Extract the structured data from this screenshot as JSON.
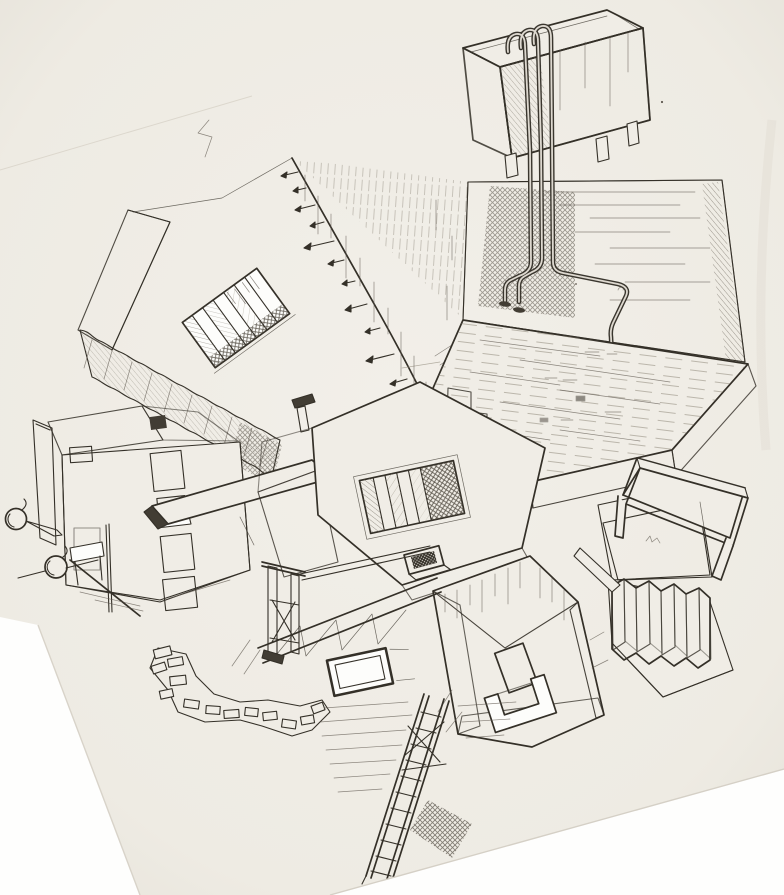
{
  "scene": {
    "description": "Hand-drawn pencil and ink architectural sketch on tilted scanned paper: an Escher-like impossible assembly of buildings, staircases, a pipe-topped tank on legs, plank platform, sunken stair pit, table over a pit, accordion-folded wall, truss girder, crumbling brick band and leaning ladders.",
    "elements": [
      {
        "name": "tank-box-with-pipes",
        "note": "hatched box on short legs, three pipes hooked over its rim"
      },
      {
        "name": "pipe-run",
        "note": "pipes descend a hatched concrete wall and plunge into a plank platform"
      },
      {
        "name": "plank-platform",
        "note": "large tilted wooden slab with plank dashes and notched corner"
      },
      {
        "name": "arrow-ridge-wall",
        "note": "large blank wall with a ridge studded with small left-pointing arrows"
      },
      {
        "name": "stair-window",
        "note": "rotated rectangular opening with steps inside"
      },
      {
        "name": "zigzag-stair-band",
        "note": "scalloped staircase edge descending left to right"
      },
      {
        "name": "left-house",
        "note": "small house with dark windows, hatched roof, porch and two sphere balloons on strings"
      },
      {
        "name": "center-stair-pit-platform",
        "note": "white platform with sunken staircase pit, peg and skylight hatch"
      },
      {
        "name": "table-over-pit",
        "note": "table structure standing above a dark cross-hatched pit"
      },
      {
        "name": "accordion-fold",
        "note": "zigzag folded wall standing on a slab"
      },
      {
        "name": "keyhole-building",
        "note": "rotated building with dark window and U-shaped balcony parapet"
      },
      {
        "name": "truss-girder",
        "note": "lattice girder and braced tower posts"
      },
      {
        "name": "framed-window",
        "note": "small dark framed window lying on a white plane"
      },
      {
        "name": "brick-crumble-band",
        "note": "ragged band of crumbling bricks"
      },
      {
        "name": "ladder",
        "note": "long braced ladder leaning across the lower sheet"
      },
      {
        "name": "paper-sheet",
        "note": "tilted sketch paper with cut white corners bottom-left and bottom-right"
      }
    ]
  },
  "colors": {
    "paper": "#f0ede6",
    "paper2": "#e8e4dc",
    "white": "#fdfdfb",
    "ink": "#343028",
    "mid": "#5f5950",
    "light": "#989183",
    "edge": "#d6d1c6"
  }
}
